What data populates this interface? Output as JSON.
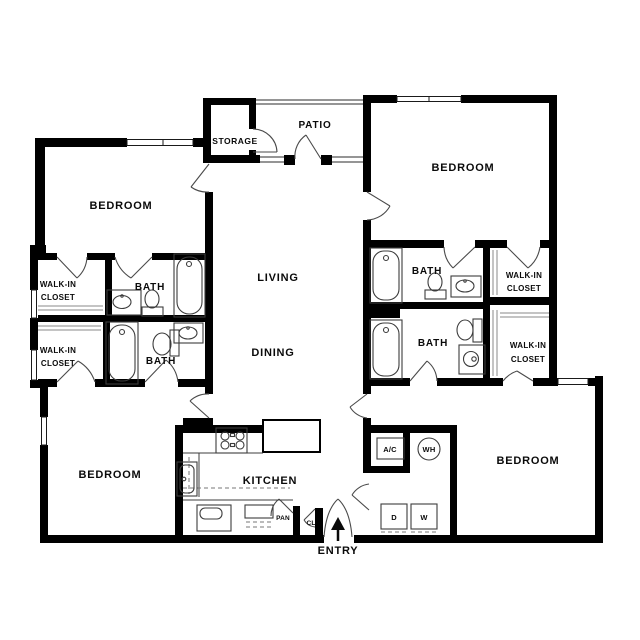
{
  "floor_plan": {
    "colors": {
      "wall": "#000000",
      "background": "#ffffff",
      "door_line": "#4a4a4a",
      "fixture_line": "#3c3c3c"
    },
    "labels": {
      "storage": "STORAGE",
      "patio": "PATIO",
      "living": "LIVING",
      "dining": "DINING",
      "kitchen": "KITCHEN",
      "entry": "ENTRY",
      "bedroom_top_left": "BEDROOM",
      "bedroom_top_right": "BEDROOM",
      "bedroom_bottom_left": "BEDROOM",
      "bedroom_bottom_right": "BEDROOM",
      "bath_upper_left": "BATH",
      "bath_lower_left": "BATH",
      "bath_upper_right": "BATH",
      "bath_lower_right": "BATH",
      "walk_in_closet_line1": "WALK-IN",
      "walk_in_closet_line2": "CLOSET",
      "air_conditioner": "A/C",
      "water_heater": "WH",
      "pantry": "PAN",
      "coat_closet": "CL",
      "dryer": "D",
      "washer": "W"
    }
  }
}
